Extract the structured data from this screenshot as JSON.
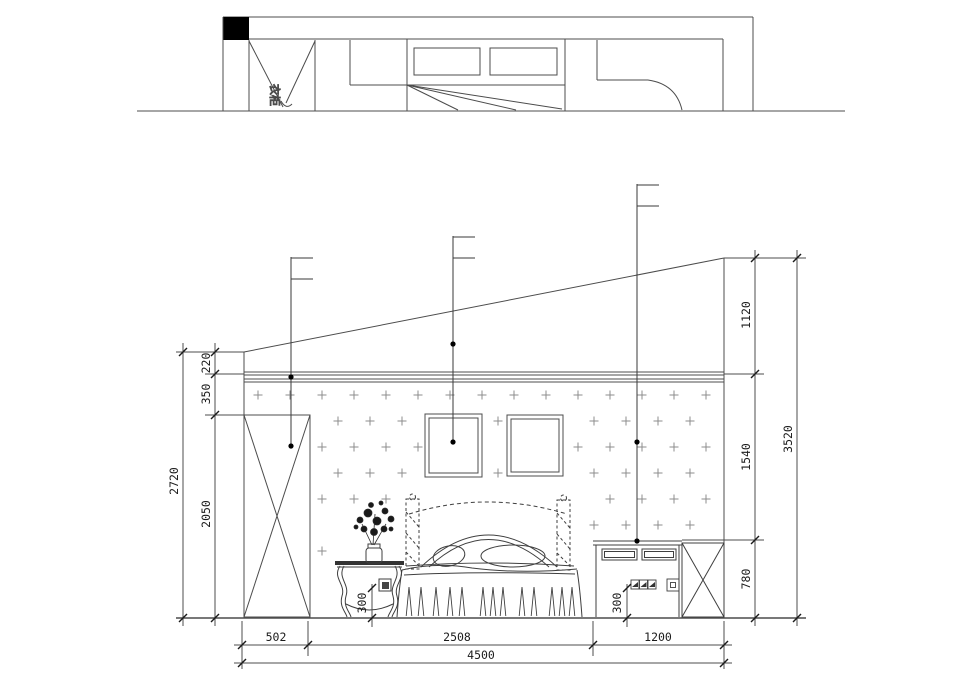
{
  "meta": {
    "background": "#ffffff",
    "line_color": "#4c4c4c",
    "wallpaper_color": "#8c8c8c",
    "callout_dot_color": "#000000"
  },
  "plan": {
    "wardrobe_label": "衣柜"
  },
  "dims": {
    "left": {
      "seg1": "220",
      "seg2": "350",
      "seg3": "2050",
      "total": "2720"
    },
    "right": {
      "seg1": "1120",
      "seg2": "1540",
      "seg3": "780",
      "total": "3520"
    },
    "bottom": {
      "seg1": "502",
      "seg2": "2508",
      "seg3": "1200",
      "total": "4500"
    },
    "outlet_left_height": "300",
    "outlet_right_height": "300"
  }
}
